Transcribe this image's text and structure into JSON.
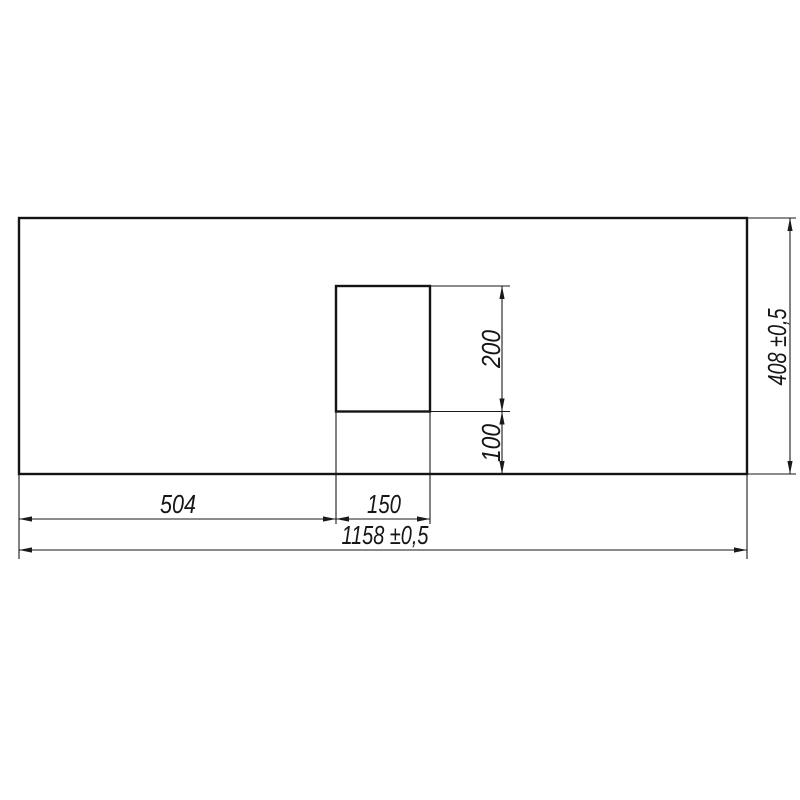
{
  "drawing": {
    "background_color": "#ffffff",
    "line_color": "#1a1a1a",
    "part": {
      "outer_outline_px": {
        "x": 19,
        "y": 218,
        "width": 728,
        "height": 256
      },
      "cutout_outline_px": {
        "x": 336,
        "y": 286,
        "width": 94,
        "height": 125.5
      }
    },
    "dimensions": [
      {
        "name": "cutout-offset-left",
        "label": "504",
        "value": 504,
        "tolerance": "",
        "axis": "x",
        "p1": 19,
        "p2": 336,
        "at": 519,
        "text": {
          "x": 178,
          "y": 513,
          "rotate": 0,
          "length": 36
        }
      },
      {
        "name": "cutout-width",
        "label": "150",
        "value": 150,
        "tolerance": "",
        "axis": "x",
        "p1": 336,
        "p2": 430,
        "at": 519,
        "text": {
          "x": 384,
          "y": 513,
          "rotate": 0,
          "length": 34
        }
      },
      {
        "name": "overall-width",
        "label": "1158 ±0,5",
        "value": 1158,
        "tolerance": "±0,5",
        "axis": "x",
        "p1": 19,
        "p2": 747,
        "at": 550,
        "text": {
          "x": 385,
          "y": 544,
          "rotate": 0,
          "length": 87
        }
      },
      {
        "name": "cutout-height",
        "label": "200",
        "value": 200,
        "tolerance": "",
        "axis": "y",
        "p1": 286,
        "p2": 411.5,
        "at": 502,
        "text": {
          "x": 500,
          "y": 349,
          "rotate": -90,
          "length": 38
        }
      },
      {
        "name": "cutout-offset-bottom",
        "label": "100",
        "value": 100,
        "tolerance": "",
        "axis": "y",
        "p1": 411.5,
        "p2": 474,
        "at": 502,
        "text": {
          "x": 500,
          "y": 443,
          "rotate": -90,
          "length": 38
        }
      },
      {
        "name": "overall-height",
        "label": "408 ±0,5",
        "value": 408,
        "tolerance": "±0,5",
        "axis": "y",
        "p1": 218,
        "p2": 474,
        "at": 790,
        "text": {
          "x": 786,
          "y": 347,
          "rotate": -90,
          "length": 77
        }
      }
    ],
    "extension_lines_px": [
      {
        "x1": 336,
        "y1": 411.5,
        "x2": 336,
        "y2": 524
      },
      {
        "x1": 430,
        "y1": 411.5,
        "x2": 430,
        "y2": 524
      },
      {
        "x1": 430,
        "y1": 286,
        "x2": 510,
        "y2": 286
      },
      {
        "x1": 430,
        "y1": 411.5,
        "x2": 510,
        "y2": 411.5
      },
      {
        "x1": 747,
        "y1": 218,
        "x2": 796,
        "y2": 218
      },
      {
        "x1": 747,
        "y1": 474,
        "x2": 796,
        "y2": 474
      },
      {
        "x1": 19,
        "y1": 474,
        "x2": 19,
        "y2": 559
      },
      {
        "x1": 747,
        "y1": 474,
        "x2": 747,
        "y2": 559
      }
    ]
  }
}
